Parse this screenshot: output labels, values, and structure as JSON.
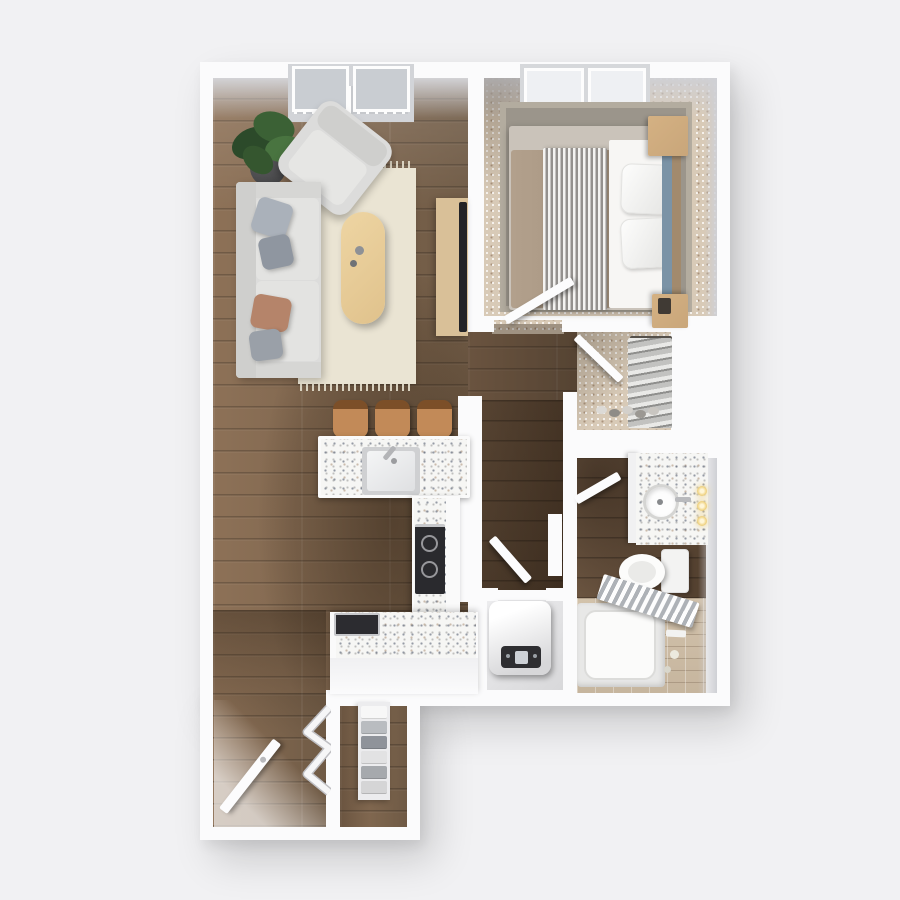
{
  "scene": {
    "title": "apartment-3d-floor-plan-top-view",
    "background": "#f1f1f3",
    "colors": {
      "bg": "#f1f1f3",
      "wall": "#fbfbfc",
      "face": "#cfd0d5",
      "wood-hi": "#8d7157",
      "wood-lo": "#6f5a45",
      "wood-dark-hi": "#6a5440",
      "wood-dark-lo": "#53402f",
      "rug-cream": "#eae4d3",
      "sofa": "#dcdcdb",
      "sofa-dark": "#cfcfcd",
      "pillow-gray": "#aab1ba",
      "pillow-slate": "#8f96a0",
      "pillow-tan": "#b5846a",
      "table-wood": "#eed5a3",
      "console-wood": "#d9c098",
      "tv": "#232327",
      "plant": "#3b6135",
      "plant-dark": "#2c4a2a",
      "pot": "#3f3f41",
      "carpet-base": "#d8cab7",
      "rug-gray": "#9b958b",
      "rug-gray-border": "#b3ac9f",
      "duvet": "#b2a08c",
      "sheet": "#f7f6f4",
      "stripe-dark": "#94918e",
      "headboard-wood": "#a28a6d",
      "headboard-blue": "#7b93a6",
      "nightstand": "#c9a67a",
      "terrazzo": "#f6f6f4",
      "stool": "#c28a58",
      "stool-back": "#7c4f28",
      "stove": "#2a2a2e",
      "steel": "#c7c8cb",
      "fixture": "#fafafa",
      "tile-hi": "#d2c2ab",
      "tile-lo": "#c6b59e",
      "heater-panel": "#2e2e31",
      "glow": "#eecf7a"
    },
    "rooms": [
      {
        "name": "living-room",
        "floor": "wood",
        "items": [
          "balcony-doors",
          "juliet-railing",
          "potted-plant",
          "armchair",
          "sofa",
          "throw-pillows",
          "cream-area-rug",
          "oval-coffee-table",
          "media-console",
          "tv"
        ]
      },
      {
        "name": "kitchen",
        "floor": "wood",
        "items": [
          "bar-stools-x3",
          "peninsula-counter",
          "kitchen-sink",
          "faucet",
          "cooktop",
          "wall-oven",
          "base-cabinets"
        ]
      },
      {
        "name": "bedroom",
        "floor": "speckled-carpet",
        "items": [
          "window",
          "bed",
          "tan-duvet",
          "striped-throw",
          "white-pillows",
          "blue-headboard",
          "nightstand-north",
          "nightstand-south",
          "gray-rug",
          "swing-door"
        ]
      },
      {
        "name": "walk-in-closet",
        "floor": "speckled-carpet",
        "items": [
          "hanging-clothes",
          "shoe-row",
          "swing-door"
        ]
      },
      {
        "name": "bathroom",
        "floor": "wood-and-tile",
        "items": [
          "vanity-counter",
          "round-sink",
          "faucet",
          "sconce-lights-x3",
          "toilet",
          "bathtub",
          "shower-curtain",
          "towel-hardware",
          "swing-door"
        ]
      },
      {
        "name": "hallway",
        "floor": "wood",
        "items": []
      },
      {
        "name": "utility-closet",
        "floor": "vinyl",
        "items": [
          "water-heater",
          "swing-door"
        ]
      },
      {
        "name": "entry",
        "floor": "wood",
        "items": [
          "front-door",
          "bifold-closet-doors",
          "linen-closet",
          "folded-linens"
        ]
      }
    ]
  }
}
